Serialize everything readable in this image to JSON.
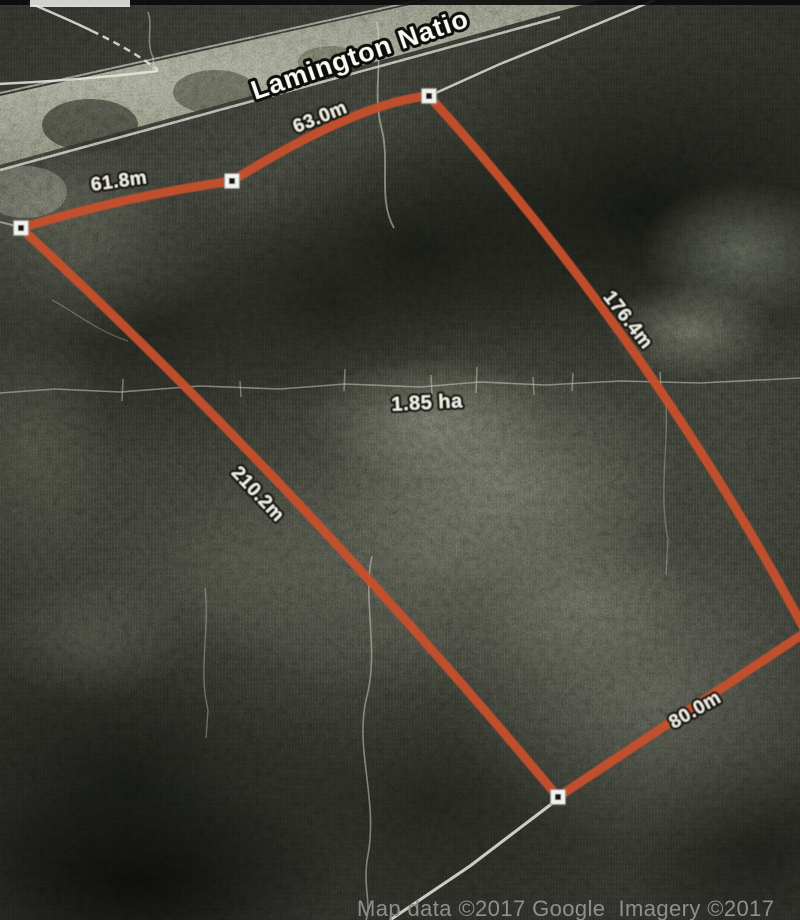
{
  "map": {
    "road_label": "Lamington Natio",
    "area_label": "1.85 ha",
    "attribution": "Map data ©2017 Google  Imagery ©2017",
    "measurements": {
      "northwest_side": "61.8m",
      "north_side": "63.0m",
      "east_side": "176.4m",
      "southwest_side": "210.2m",
      "south_side": "80.0m"
    },
    "colors": {
      "parcel_line": "#c7502d",
      "label_fill": "#f2f0e8",
      "label_halo": "#15150f",
      "attribution_text": "#8f8f8f"
    },
    "icons": {
      "vertex_marker": "white square with black dot"
    }
  }
}
